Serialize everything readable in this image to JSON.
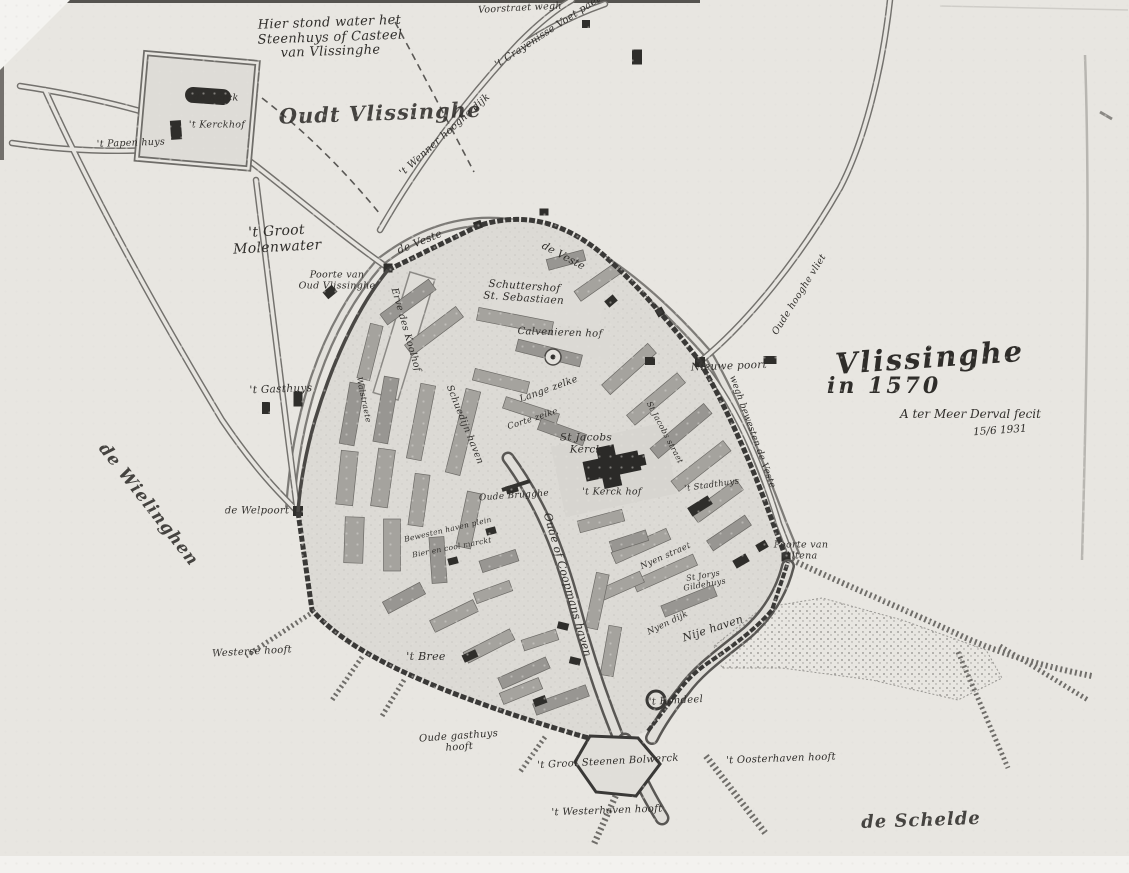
{
  "map": {
    "title": {
      "name": "Vlissinghe",
      "year": "in 1570",
      "credit": "A ter Meer Derval fecit",
      "date": "15/6 1931"
    },
    "palette": {
      "paper": "#e8e6e1",
      "ink": "#3a3937",
      "block": "#a5a39e",
      "building": "#2f2e2b"
    },
    "labels": [
      {
        "id": "steenhuys-note",
        "text": "Hier stond water het\nSteenhuys of Casteel\nvan Vlissinghe",
        "x": 330,
        "y": 38,
        "rot": -2,
        "size": 13,
        "cls": "hand"
      },
      {
        "id": "oudt-vlissinghe",
        "text": "Oudt Vlissinghe",
        "x": 380,
        "y": 113,
        "rot": -2,
        "size": 21,
        "cls": "script"
      },
      {
        "id": "de-kerck",
        "text": "de Kerck",
        "x": 216,
        "y": 99,
        "rot": 0,
        "size": 9.5,
        "cls": "hand"
      },
      {
        "id": "kerckhof-oudt",
        "text": "'t Kerckhof",
        "x": 217,
        "y": 126,
        "rot": 0,
        "size": 9.5,
        "cls": "hand"
      },
      {
        "id": "papen-huys",
        "text": "'t Papen huys",
        "x": 131,
        "y": 144,
        "rot": -2,
        "size": 9.5,
        "cls": "hand"
      },
      {
        "id": "top-road-left",
        "text": "'t Wenner hooghe dijk",
        "x": 445,
        "y": 135,
        "rot": -42,
        "size": 10,
        "cls": "hand"
      },
      {
        "id": "top-road-right",
        "text": "'t Crayenisse Voet paet",
        "x": 548,
        "y": 32,
        "rot": -33,
        "size": 10,
        "cls": "hand"
      },
      {
        "id": "top-edge-road",
        "text": "Voorstraet wegh",
        "x": 520,
        "y": 9,
        "rot": -3,
        "size": 9.5,
        "cls": "hand"
      },
      {
        "id": "groot-molenwater",
        "text": "'t Groot\nMolenwater",
        "x": 277,
        "y": 240,
        "rot": -3,
        "size": 14,
        "cls": "hand"
      },
      {
        "id": "poorte-oud-vlissinghe",
        "text": "Poorte van\nOud Vlissinghe",
        "x": 337,
        "y": 281,
        "rot": 0,
        "size": 9.5,
        "cls": "hand"
      },
      {
        "id": "veste-west",
        "text": "de Veste",
        "x": 420,
        "y": 243,
        "rot": -22,
        "size": 10.5,
        "cls": "hand"
      },
      {
        "id": "veste-east",
        "text": "de Veste",
        "x": 563,
        "y": 257,
        "rot": 28,
        "size": 10.5,
        "cls": "hand"
      },
      {
        "id": "schuttershof",
        "text": "Schuttershof\nSt. Sebastiaen",
        "x": 524,
        "y": 293,
        "rot": 4,
        "size": 10.5,
        "cls": "hand"
      },
      {
        "id": "calvenieren-hof",
        "text": "Calvenieren hof",
        "x": 560,
        "y": 333,
        "rot": 2,
        "size": 10,
        "cls": "hand"
      },
      {
        "id": "erve-koolhof",
        "text": "Erve des Koolhof",
        "x": 405,
        "y": 330,
        "rot": 74,
        "size": 9.5,
        "cls": "hand"
      },
      {
        "id": "lange-zelke",
        "text": "Lange zelke",
        "x": 549,
        "y": 390,
        "rot": -20,
        "size": 9.5,
        "cls": "hand"
      },
      {
        "id": "corte-zelke",
        "text": "Corte zelke",
        "x": 533,
        "y": 420,
        "rot": -18,
        "size": 8.5,
        "cls": "hand"
      },
      {
        "id": "st-jacobs-straet",
        "text": "St Jacobs straet",
        "x": 664,
        "y": 433,
        "rot": 62,
        "size": 8,
        "cls": "hand"
      },
      {
        "id": "st-jacobs-kerck",
        "text": "St Jacobs\nKerck",
        "x": 586,
        "y": 444,
        "rot": 0,
        "size": 10.5,
        "cls": "hand"
      },
      {
        "id": "kerck-hof",
        "text": "'t Kerck hof",
        "x": 612,
        "y": 493,
        "rot": 0,
        "size": 9.5,
        "cls": "hand"
      },
      {
        "id": "oude-brugghe",
        "text": "Oude Brugghe",
        "x": 514,
        "y": 496,
        "rot": -4,
        "size": 9,
        "cls": "hand"
      },
      {
        "id": "stadthuys",
        "text": "'t Stadthuys",
        "x": 712,
        "y": 486,
        "rot": -8,
        "size": 8.5,
        "cls": "hand"
      },
      {
        "id": "nyen-straet",
        "text": "Nyen straet",
        "x": 666,
        "y": 557,
        "rot": -24,
        "size": 8.5,
        "cls": "hand"
      },
      {
        "id": "st-jorys-gildehuys",
        "text": "St Jorys\nGildehuys",
        "x": 704,
        "y": 581,
        "rot": -10,
        "size": 8,
        "cls": "hand"
      },
      {
        "id": "nyen-dijk",
        "text": "Nyen dijk",
        "x": 668,
        "y": 624,
        "rot": -26,
        "size": 8.5,
        "cls": "hand"
      },
      {
        "id": "coopmans-haven",
        "text": "Oude of Coopmans haven",
        "x": 567,
        "y": 585,
        "rot": 74,
        "size": 11,
        "cls": "hand"
      },
      {
        "id": "schuedijn-haven",
        "text": "Schuedijn haven",
        "x": 464,
        "y": 425,
        "rot": 68,
        "size": 9.5,
        "cls": "hand"
      },
      {
        "id": "walstraete",
        "text": "Walstraete",
        "x": 363,
        "y": 400,
        "rot": 78,
        "size": 8,
        "cls": "hand"
      },
      {
        "id": "bewesten-haven-plein",
        "text": "Bewesten haven plein",
        "x": 448,
        "y": 530,
        "rot": -13,
        "size": 7.5,
        "cls": "hand"
      },
      {
        "id": "bier-coolmarkt",
        "text": "Bier en cool marckt",
        "x": 452,
        "y": 548,
        "rot": -11,
        "size": 7.5,
        "cls": "hand"
      },
      {
        "id": "gasthuys",
        "text": "'t Gasthuys",
        "x": 281,
        "y": 390,
        "rot": -2,
        "size": 10.5,
        "cls": "hand"
      },
      {
        "id": "welpoort",
        "text": "de Welpoort",
        "x": 257,
        "y": 511,
        "rot": 0,
        "size": 10,
        "cls": "hand"
      },
      {
        "id": "wielinghen",
        "text": "de Wielinghen",
        "x": 148,
        "y": 505,
        "rot": 52,
        "size": 17,
        "cls": "script"
      },
      {
        "id": "westerse-hooft",
        "text": "Westerse hooft",
        "x": 252,
        "y": 652,
        "rot": -3,
        "size": 10,
        "cls": "hand"
      },
      {
        "id": "bree",
        "text": "'t Bree",
        "x": 426,
        "y": 657,
        "rot": 0,
        "size": 11,
        "cls": "hand"
      },
      {
        "id": "oude-gasthuys-hooft",
        "text": "Oude gasthuys\nhooft",
        "x": 459,
        "y": 742,
        "rot": -4,
        "size": 10,
        "cls": "hand"
      },
      {
        "id": "groot-steenen-bolwerck",
        "text": "'t Groot Steenen Bolwerck",
        "x": 608,
        "y": 762,
        "rot": -3,
        "size": 10,
        "cls": "hand"
      },
      {
        "id": "rondeel",
        "text": "'t Rondeel",
        "x": 676,
        "y": 701,
        "rot": -3,
        "size": 10,
        "cls": "hand"
      },
      {
        "id": "nije-haven",
        "text": "Nije haven",
        "x": 713,
        "y": 629,
        "rot": -18,
        "size": 11,
        "cls": "hand"
      },
      {
        "id": "oosterhaven-hooft",
        "text": "'t Oosterhaven hooft",
        "x": 781,
        "y": 759,
        "rot": -2,
        "size": 10,
        "cls": "hand"
      },
      {
        "id": "westerhaven-hooft",
        "text": "'t Westerhaven hooft",
        "x": 607,
        "y": 811,
        "rot": -2,
        "size": 10,
        "cls": "hand"
      },
      {
        "id": "de-schelde",
        "text": "de Schelde",
        "x": 921,
        "y": 821,
        "rot": -2,
        "size": 18,
        "cls": "script"
      },
      {
        "id": "poorte-van-altena",
        "text": "Poorte van\nAltena",
        "x": 801,
        "y": 551,
        "rot": 0,
        "size": 9.5,
        "cls": "hand"
      },
      {
        "id": "nieuwe-poort",
        "text": "Nieuwe poort",
        "x": 729,
        "y": 367,
        "rot": -2,
        "size": 10.5,
        "cls": "hand"
      },
      {
        "id": "weg-bewesten-veste",
        "text": "wegh bewesten de Veste",
        "x": 752,
        "y": 432,
        "rot": 70,
        "size": 9,
        "cls": "hand"
      },
      {
        "id": "oude-hooghe-vliet",
        "text": "Oude hooghe vliet",
        "x": 800,
        "y": 295,
        "rot": -58,
        "size": 9.5,
        "cls": "hand"
      }
    ]
  }
}
